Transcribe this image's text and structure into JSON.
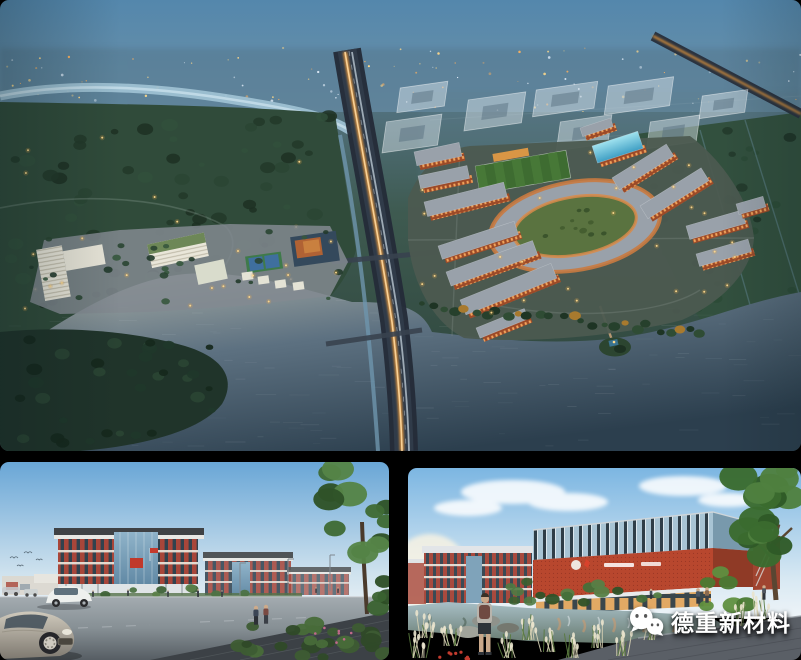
{
  "watermark": {
    "brand_text": "德重新材料",
    "icon": "wechat-logo",
    "text_color": "#ffffff"
  },
  "palette": {
    "background": "#000000",
    "dusk_sky": "#5487ac",
    "water_dark": "#2c3f4e",
    "lake_light": "#aeb2a9",
    "forest_green": "#2a4534",
    "campus_brick": "#9c4a28",
    "window_glow": "#f2a55c",
    "roof_gray": "#99a1aa",
    "ring_lawn": "#5a7340",
    "highway_glow": "#e89a3c",
    "day_sky": "#7cb6e2",
    "brick_red": "#a8463a",
    "facade_red": "#b8472e",
    "road_gray": "#8e979c",
    "pond_green": "#7a8f85"
  }
}
